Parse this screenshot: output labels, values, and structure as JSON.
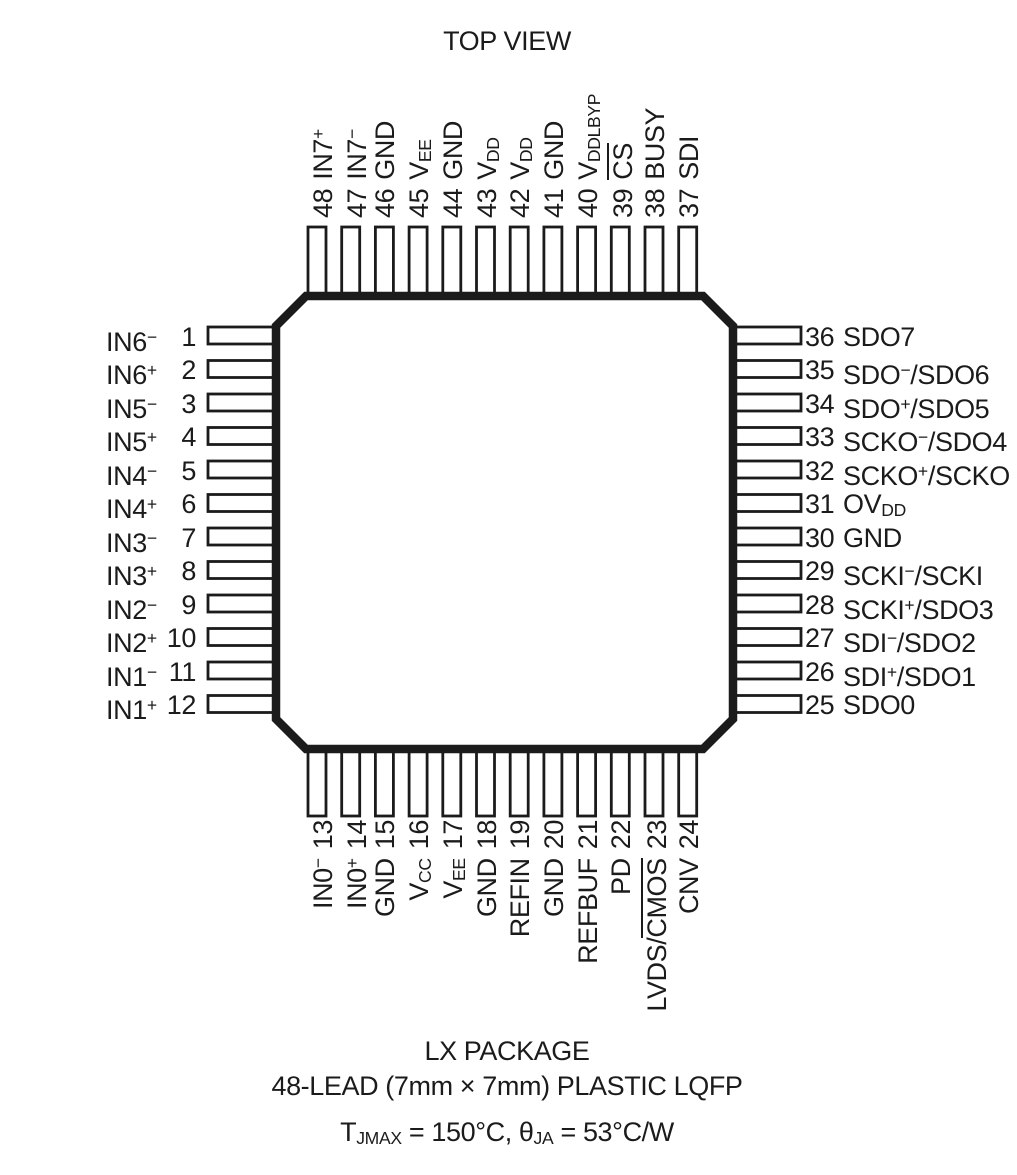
{
  "title": "TOP VIEW",
  "colors": {
    "ink": "#1b1b1b",
    "background": "#ffffff"
  },
  "pins": {
    "top": [
      {
        "num": "48",
        "label": "IN7^+^"
      },
      {
        "num": "47",
        "label": "IN7^−^"
      },
      {
        "num": "46",
        "label": "GND"
      },
      {
        "num": "45",
        "label": "V_EE_"
      },
      {
        "num": "44",
        "label": "GND"
      },
      {
        "num": "43",
        "label": "V_DD_"
      },
      {
        "num": "42",
        "label": "V_DD_"
      },
      {
        "num": "41",
        "label": "GND"
      },
      {
        "num": "40",
        "label": "V_DDLBYP_"
      },
      {
        "num": "39",
        "label": "~CS~"
      },
      {
        "num": "38",
        "label": "BUSY"
      },
      {
        "num": "37",
        "label": "SDI"
      }
    ],
    "left": [
      {
        "num": "1",
        "label": "IN6^−^"
      },
      {
        "num": "2",
        "label": "IN6^+^"
      },
      {
        "num": "3",
        "label": "IN5^−^"
      },
      {
        "num": "4",
        "label": "IN5^+^"
      },
      {
        "num": "5",
        "label": "IN4^−^"
      },
      {
        "num": "6",
        "label": "IN4^+^"
      },
      {
        "num": "7",
        "label": "IN3^−^"
      },
      {
        "num": "8",
        "label": "IN3^+^"
      },
      {
        "num": "9",
        "label": "IN2^−^"
      },
      {
        "num": "10",
        "label": "IN2^+^"
      },
      {
        "num": "11",
        "label": "IN1^−^"
      },
      {
        "num": "12",
        "label": "IN1^+^"
      }
    ],
    "right": [
      {
        "num": "36",
        "label": "SDO7"
      },
      {
        "num": "35",
        "label": "SDO^−^/SDO6"
      },
      {
        "num": "34",
        "label": "SDO^+^/SDO5"
      },
      {
        "num": "33",
        "label": "SCKO^−^/SDO4"
      },
      {
        "num": "32",
        "label": "SCKO^+^/SCKO"
      },
      {
        "num": "31",
        "label": "OV_DD_"
      },
      {
        "num": "30",
        "label": "GND"
      },
      {
        "num": "29",
        "label": "SCKI^−^/SCKI"
      },
      {
        "num": "28",
        "label": "SCKI^+^/SDO3"
      },
      {
        "num": "27",
        "label": "SDI^−^/SDO2"
      },
      {
        "num": "26",
        "label": "SDI^+^/SDO1"
      },
      {
        "num": "25",
        "label": "SDO0"
      }
    ],
    "bottom": [
      {
        "num": "13",
        "label": "IN0^−^"
      },
      {
        "num": "14",
        "label": "IN0^+^"
      },
      {
        "num": "15",
        "label": "GND"
      },
      {
        "num": "16",
        "label": "V_CC_"
      },
      {
        "num": "17",
        "label": "V_EE_"
      },
      {
        "num": "18",
        "label": "GND"
      },
      {
        "num": "19",
        "label": "REFIN"
      },
      {
        "num": "20",
        "label": "GND"
      },
      {
        "num": "21",
        "label": "REFBUF"
      },
      {
        "num": "22",
        "label": "PD"
      },
      {
        "num": "23",
        "label": "LVDS/~CMOS~"
      },
      {
        "num": "24",
        "label": "CNV"
      }
    ]
  },
  "caption": {
    "line1": "LX PACKAGE",
    "line2": "48-LEAD (7mm × 7mm) PLASTIC LQFP",
    "line3": "T_JMAX_ = 150°C, θ_JA_ = 53°C/W"
  }
}
